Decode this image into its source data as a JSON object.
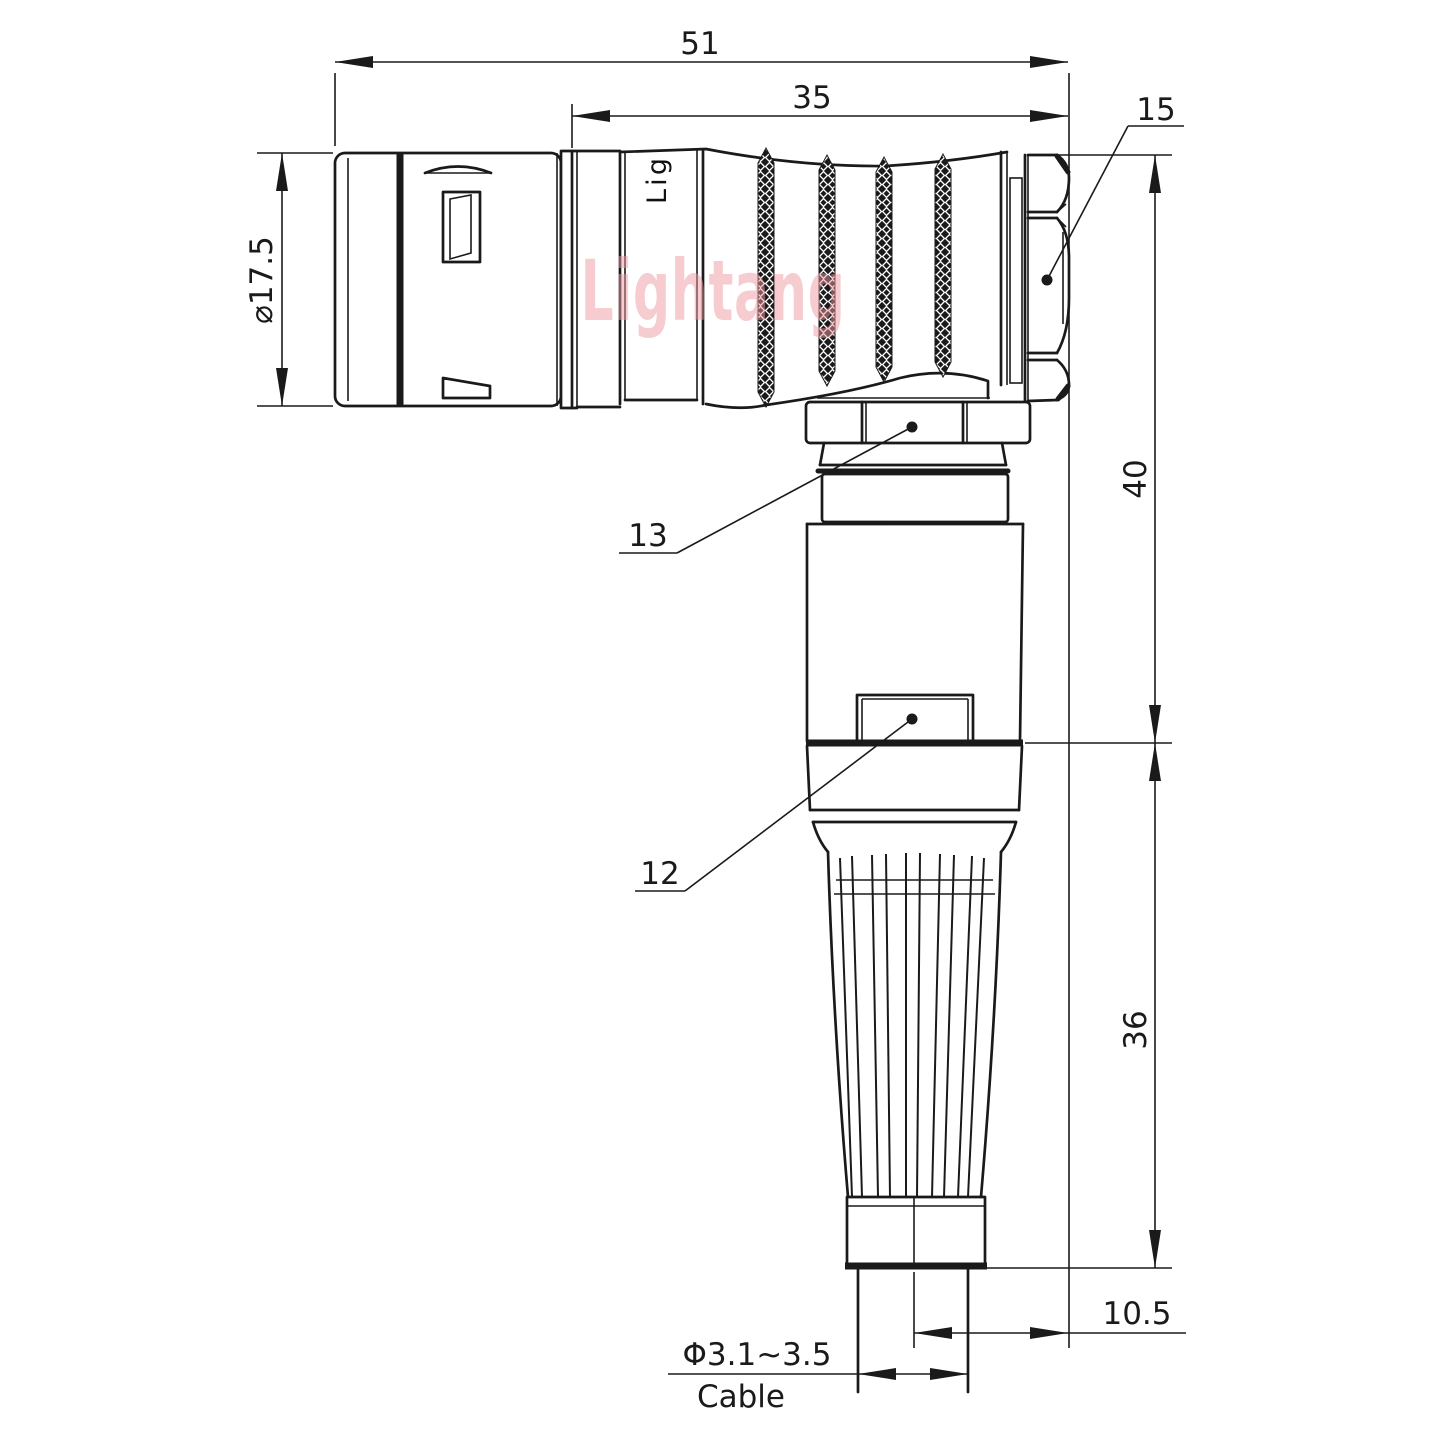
{
  "drawing": {
    "dimensions": {
      "overall_length": "51",
      "rear_length": "35",
      "hex_nut_ref": "15",
      "front_diameter": "⌀17.5",
      "upper_height": "40",
      "lower_height": "36",
      "coupling_nut_ref": "13",
      "body_ref": "12",
      "cable_offset": "10.5",
      "cable_diameter": "Φ3.1~3.5",
      "cable_caption": "Cable"
    },
    "watermark_text": "Lightang",
    "engraving_text": "Lig",
    "colors": {
      "line": "#1a1a1a",
      "watermark_pink": "#ef9aa2",
      "background": "#ffffff"
    }
  }
}
